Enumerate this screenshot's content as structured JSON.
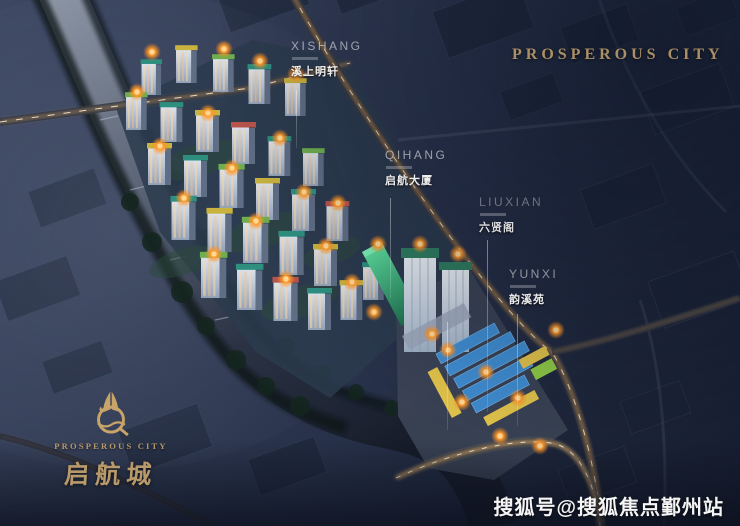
{
  "header": {
    "title": "PROSPEROUS CITY"
  },
  "labels": [
    {
      "id": "xishang",
      "en": "XISHANG",
      "zh": "溪上明轩"
    },
    {
      "id": "qihang",
      "en": "QIHANG",
      "zh": "启航大厦"
    },
    {
      "id": "liuxian",
      "en": "LIUXIAN",
      "zh": "六贤阁"
    },
    {
      "id": "yunxi",
      "en": "YUNXI",
      "zh": "韵溪苑"
    }
  ],
  "logo": {
    "emblem": "sail-q-emblem",
    "name_en": "PROSPEROUS CITY",
    "name_zh": "启航城"
  },
  "watermark": {
    "text": "搜狐号@搜狐焦点鄞州站"
  },
  "colors": {
    "gold": "#b8996a",
    "watermark": "#ffffff",
    "label": "#ffffff",
    "flame": "#ff9d2e",
    "night_sky": "#232c44",
    "water": "#5d6779",
    "commercial_blue": "#3f8cd0",
    "commercial_yellow": "#e2c34a",
    "commercial_green": "#8fca45",
    "tower_green": "#35c188"
  }
}
